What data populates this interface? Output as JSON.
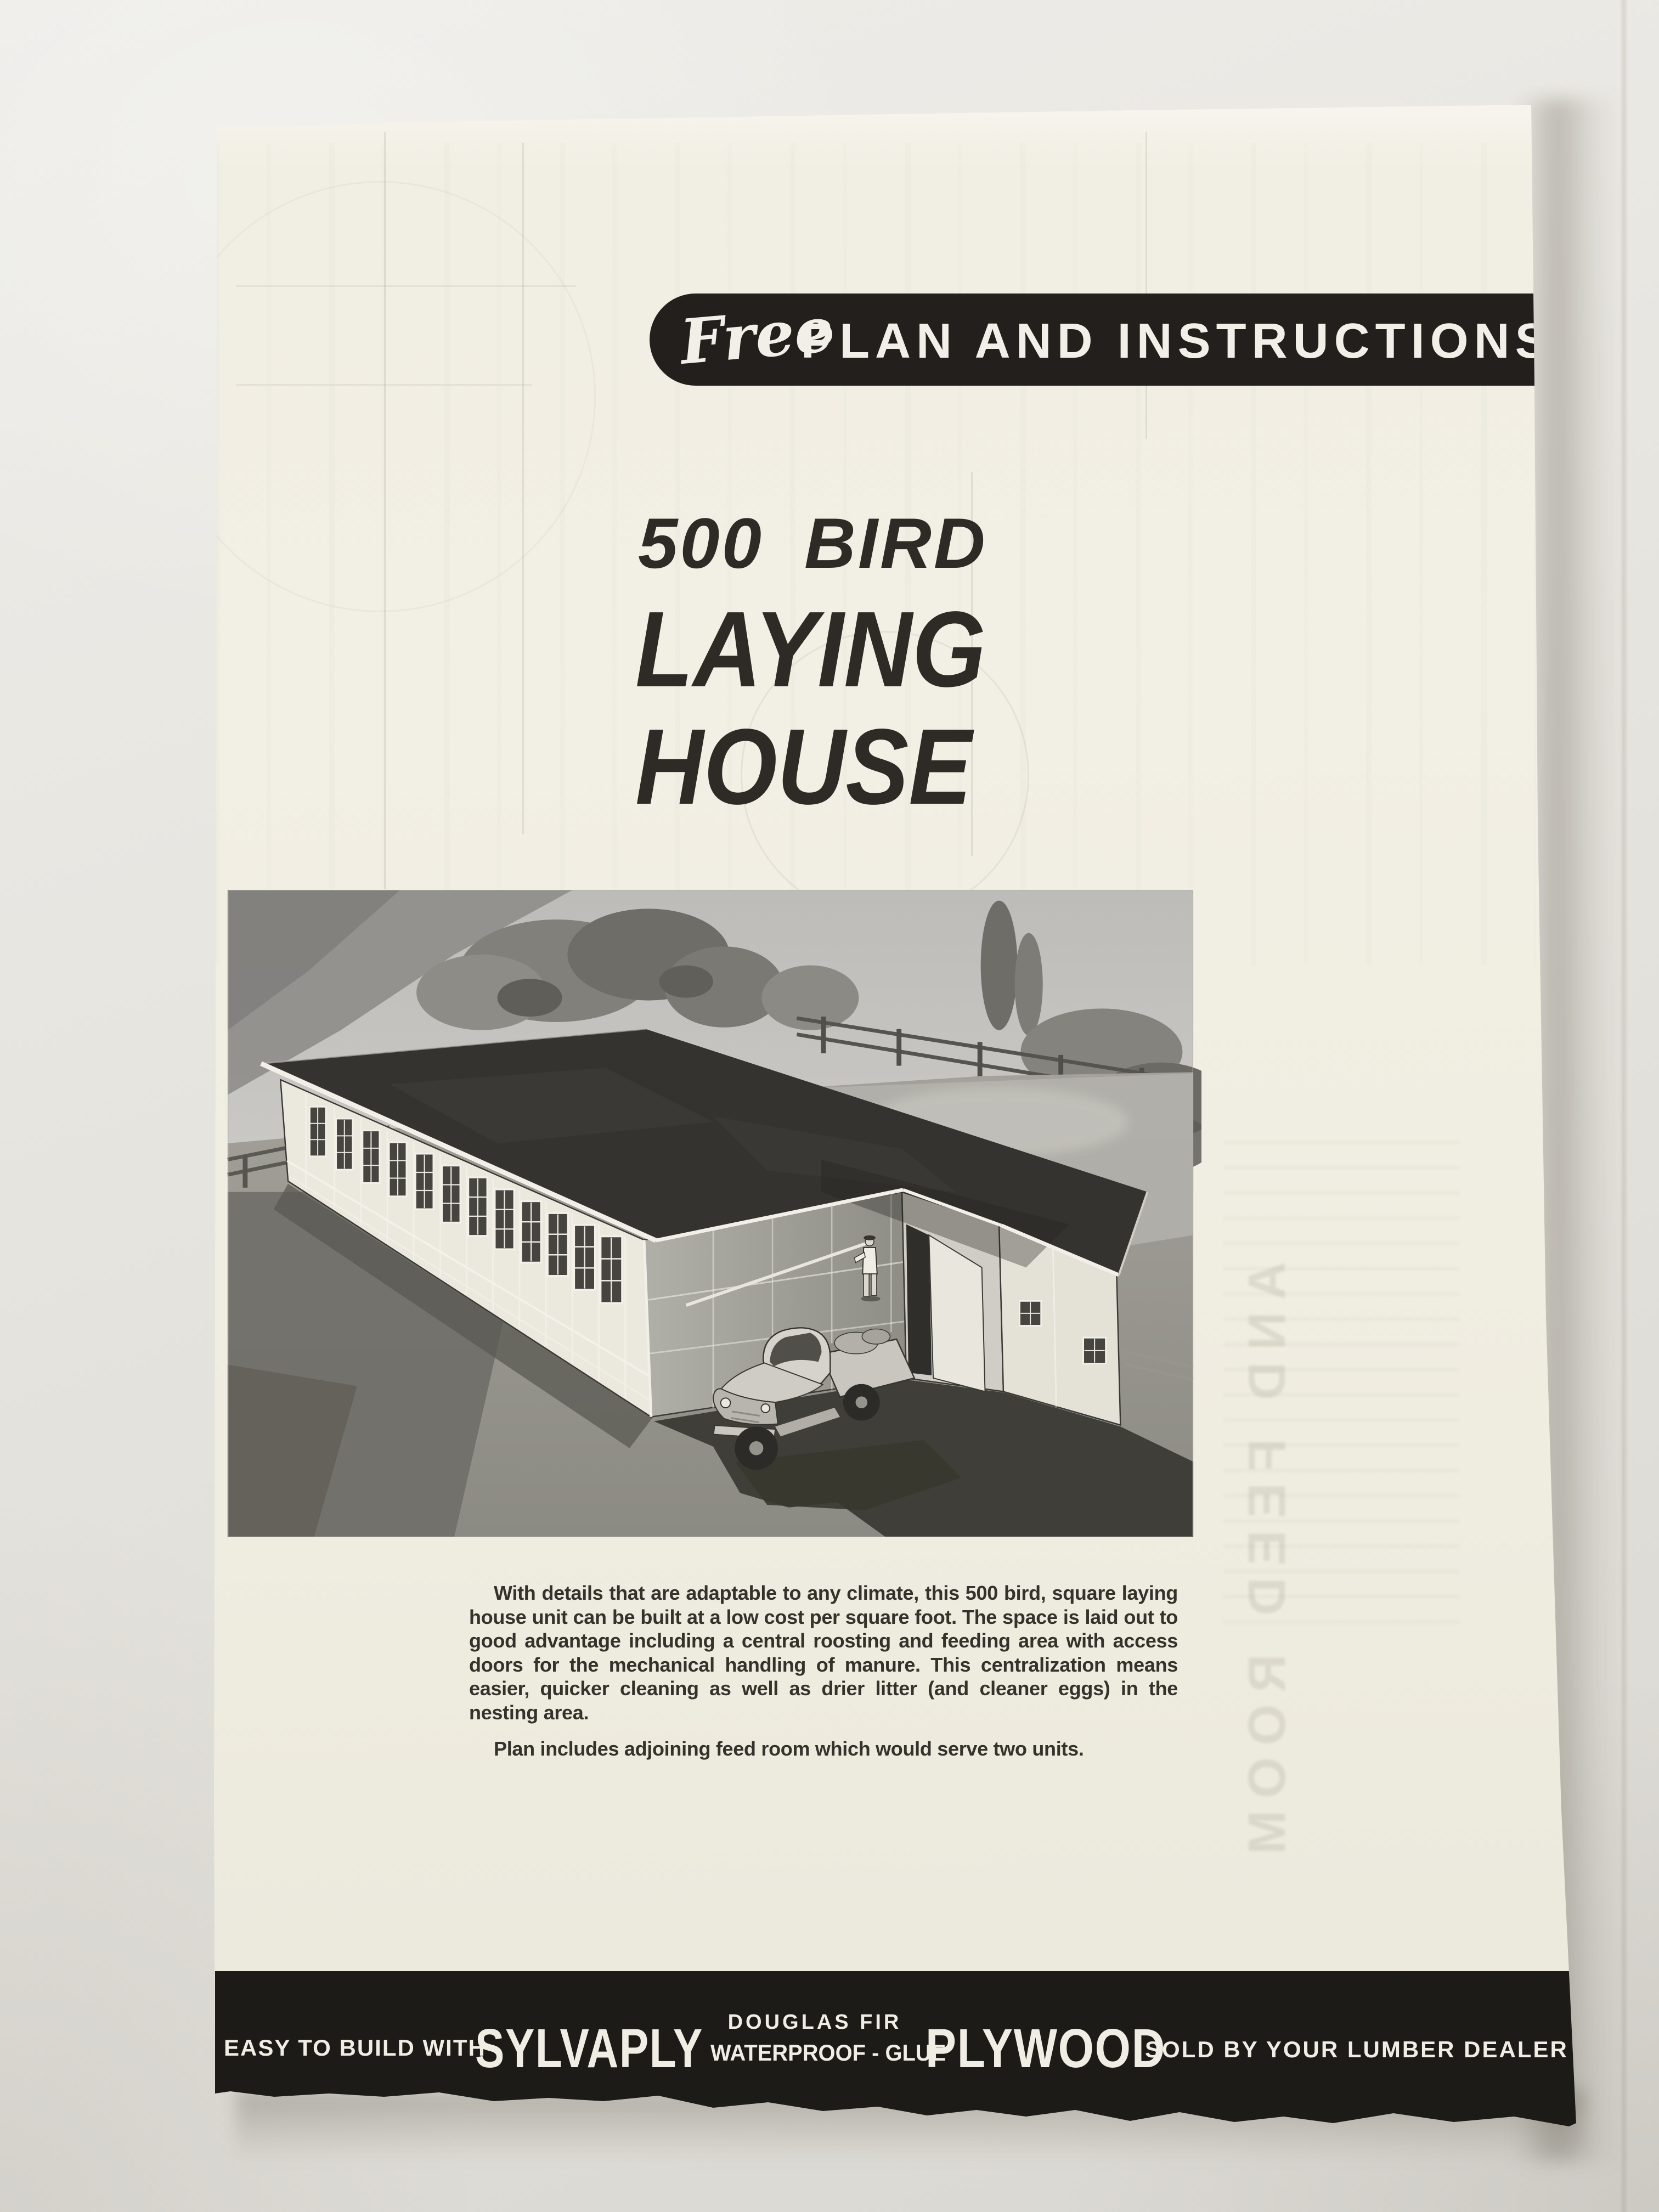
{
  "document": {
    "top_banner": {
      "script_word": "Free",
      "label": "PLAN AND INSTRUCTIONS"
    },
    "title": {
      "line1": "500 BIRD",
      "line2": "LAYING",
      "line3": "HOUSE"
    },
    "illustration_alt": "Aerial watercolor rendering of the long, low 500-bird laying house with a band of windows, adjoining feed-room wing, a farmer standing at the door, a pickup truck parked in front, rail fences, trees and shrubs behind",
    "body": {
      "paragraph1": "With details that are adaptable to any climate, this 500 bird, square laying house unit can be built at a low cost per square foot. The space is laid out to good advantage including a central roosting and feeding area with access doors for the mechanical handling of manure. This centralization means easier, quicker cleaning as well as drier litter (and cleaner eggs) in the nesting area.",
      "paragraph2": "Plan includes adjoining feed room which would serve two units."
    },
    "bottom_banner": {
      "prefix": "EASY TO BUILD WITH",
      "brand1": "SYLVAPLY",
      "stack_top": "DOUGLAS FIR",
      "stack_bottom": "WATERPROOF - GLUE",
      "brand2": "PLYWOOD",
      "suffix": "SOLD BY YOUR LUMBER DEALER"
    },
    "show_through_text": "AND FEED ROOM"
  },
  "colors": {
    "wall": "#e4e2dc",
    "paper": "#efece0",
    "ink": "#2e2b26",
    "banner_black": "#1f1c19",
    "banner_text": "#f1efe7"
  }
}
